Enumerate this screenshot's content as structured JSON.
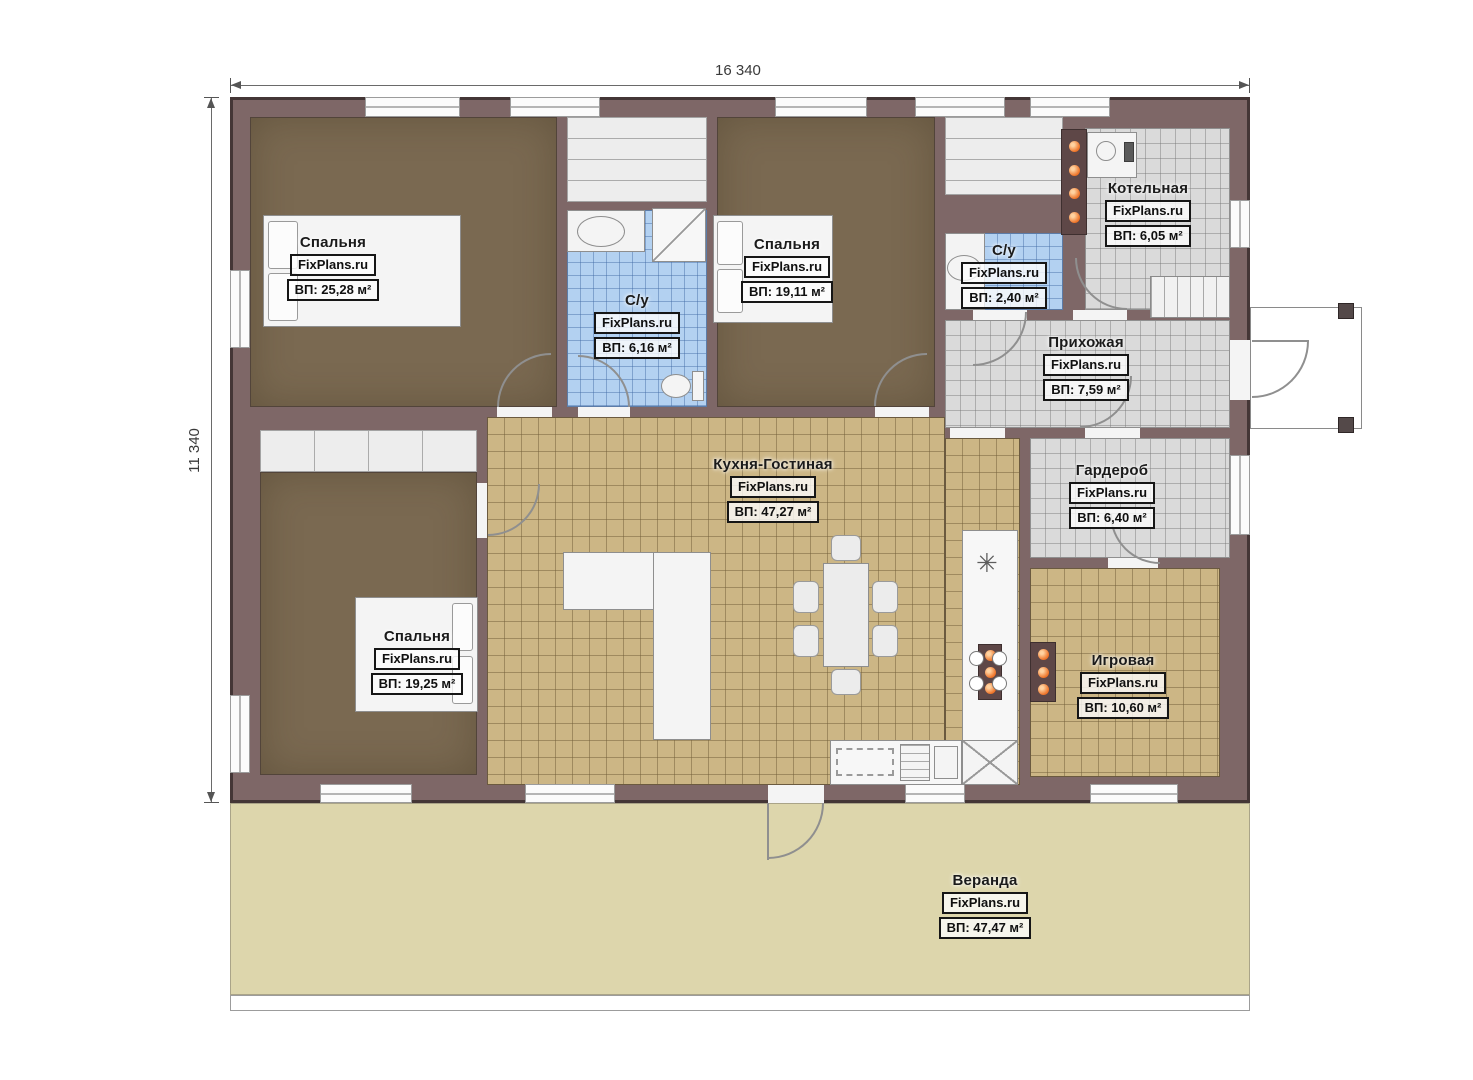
{
  "watermark": "FixPlans.ru",
  "dimensions": {
    "top": "16 340",
    "left": "11 340"
  },
  "rooms": [
    {
      "name": "Спальня",
      "area": "ВП: 25,28 м²"
    },
    {
      "name": "С/у",
      "area": "ВП: 6,16 м²"
    },
    {
      "name": "Спальня",
      "area": "ВП: 19,11 м²"
    },
    {
      "name": "С/у",
      "area": "ВП: 2,40 м²"
    },
    {
      "name": "Котельная",
      "area": "ВП: 6,05 м²"
    },
    {
      "name": "Прихожая",
      "area": "ВП: 7,59 м²"
    },
    {
      "name": "Кухня-Гостиная",
      "area": "ВП: 47,27 м²"
    },
    {
      "name": "Гардероб",
      "area": "ВП: 6,40 м²"
    },
    {
      "name": "Спальня",
      "area": "ВП: 19,25 м²"
    },
    {
      "name": "Игровая",
      "area": "ВП: 10,60 м²"
    },
    {
      "name": "Веранда",
      "area": "ВП: 47,47 м²"
    }
  ],
  "symbols": {
    "vent": "✳"
  },
  "colors": {
    "wall": "#7e6767",
    "bedroom_floor": "#7a6951",
    "kitchen_tile": "#ccb685",
    "bathroom_tile": "#b3d1f1",
    "utility_tile": "#dadada",
    "veranda_floor": "#ddd6ac",
    "radiator_orange": "#ee7226"
  }
}
